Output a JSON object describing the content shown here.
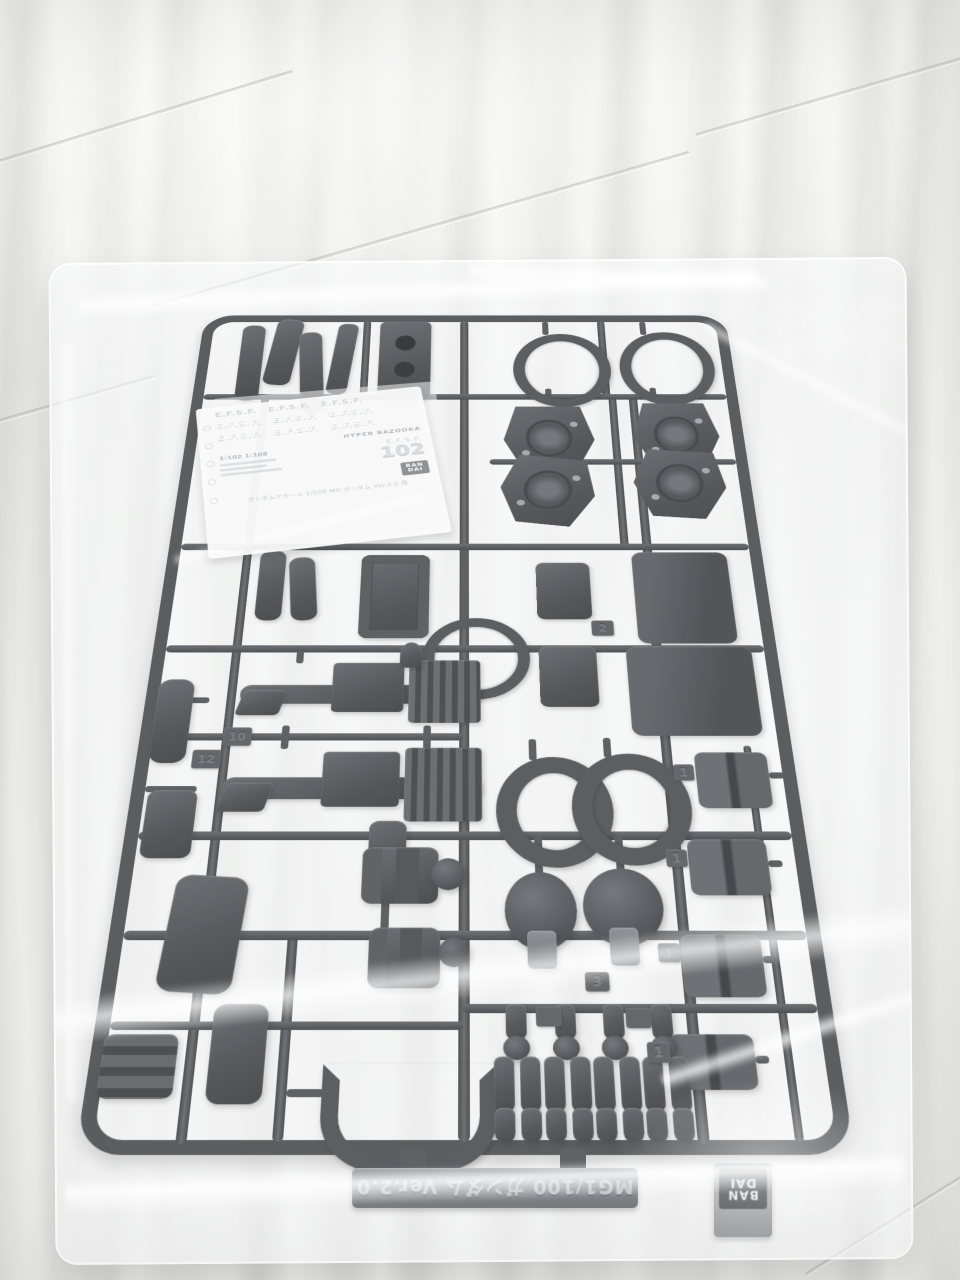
{
  "decal_sheet": {
    "marking_row_faint": "E.F.S.F.  E.F.S.F.  E.F.S.F.",
    "marking_row_bold": "E.F.S.F.  E.F.S.F.  E.F.S.F.",
    "weapon_label": "HYPER BAZOOKA",
    "scale_labels": "1:102   1:108",
    "unit_label": "E.F.S.F.",
    "unit_number": "102",
    "brand_line1": "BAN",
    "brand_line2": "DAI",
    "caption": "ガンダムデカール 1/100 MG ガンダム Ver.2.0 用"
  },
  "runner": {
    "molded_plate_text": "MG1/100 ガンダム Ver.2.0",
    "stamp_line1": "BAN",
    "stamp_line2": "DAI",
    "tags": [
      "10",
      "12",
      "2",
      "3",
      "1",
      "1",
      "1",
      "1"
    ]
  },
  "colors": {
    "plastic": "#3e4245",
    "bag_film": "#f3f4f5",
    "tile": "#e9e9e7",
    "decal_paper": "#f2f2f0",
    "accent_logo": "#35383b"
  }
}
